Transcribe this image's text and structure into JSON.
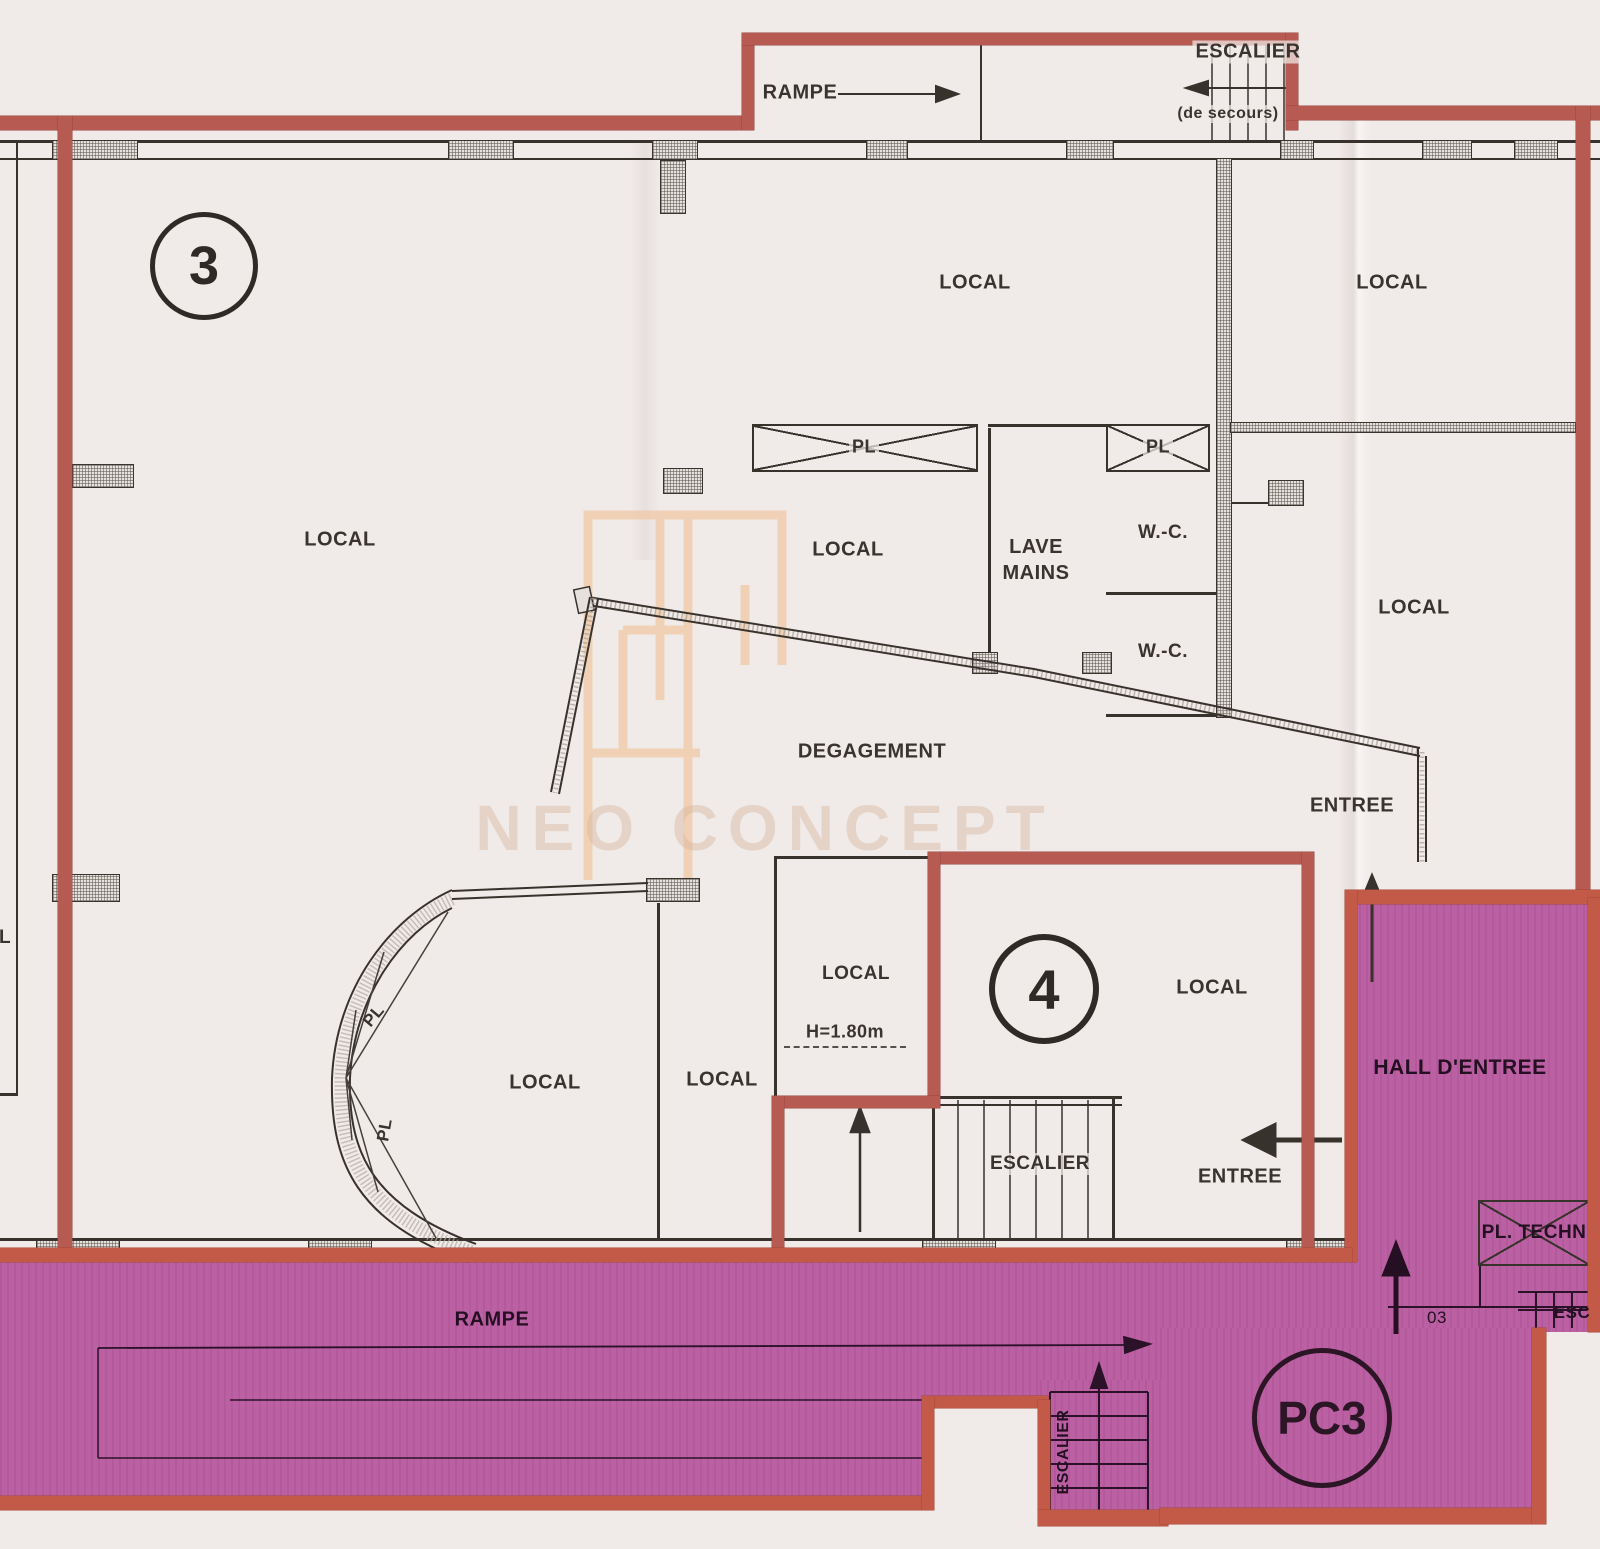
{
  "watermark": {
    "brand": "NEO CONCEPT"
  },
  "units": {
    "unit3_badge": "3",
    "unit4_badge": "4",
    "pc3_badge": "PC3"
  },
  "labels": {
    "rampe_top": "RAMPE",
    "escalier_top": "ESCALIER",
    "escalier_top_sub": "(de secours)",
    "local_top_center": "LOCAL",
    "local_top_right": "LOCAL",
    "local_main": "LOCAL",
    "pl_closet_a": "PL",
    "pl_closet_b": "PL",
    "local_center": "LOCAL",
    "lave_mains": "LAVE MAINS",
    "wc_upper": "W.-C.",
    "wc_lower": "W.-C.",
    "local_right": "LOCAL",
    "degagement": "DEGAGEMENT",
    "entree_upper": "ENTREE",
    "local_curve_left": "LOCAL",
    "local_curve_right": "LOCAL",
    "pl_curve_upper": "PL",
    "pl_curve_lower": "PL",
    "local_small_room": "LOCAL",
    "height_note": "H=1.80m",
    "local_unit4": "LOCAL",
    "escalier_unit4": "ESCALIER",
    "entree_unit4": "ENTREE",
    "hall_entree": "HALL D'ENTREE",
    "pl_techn": "PL. TECHN",
    "rampe_bottom": "RAMPE",
    "escalier_bottom": "ESCALIER",
    "door_number": "03",
    "escalier_partial": "ESC",
    "left_edge_fragment": "L"
  }
}
